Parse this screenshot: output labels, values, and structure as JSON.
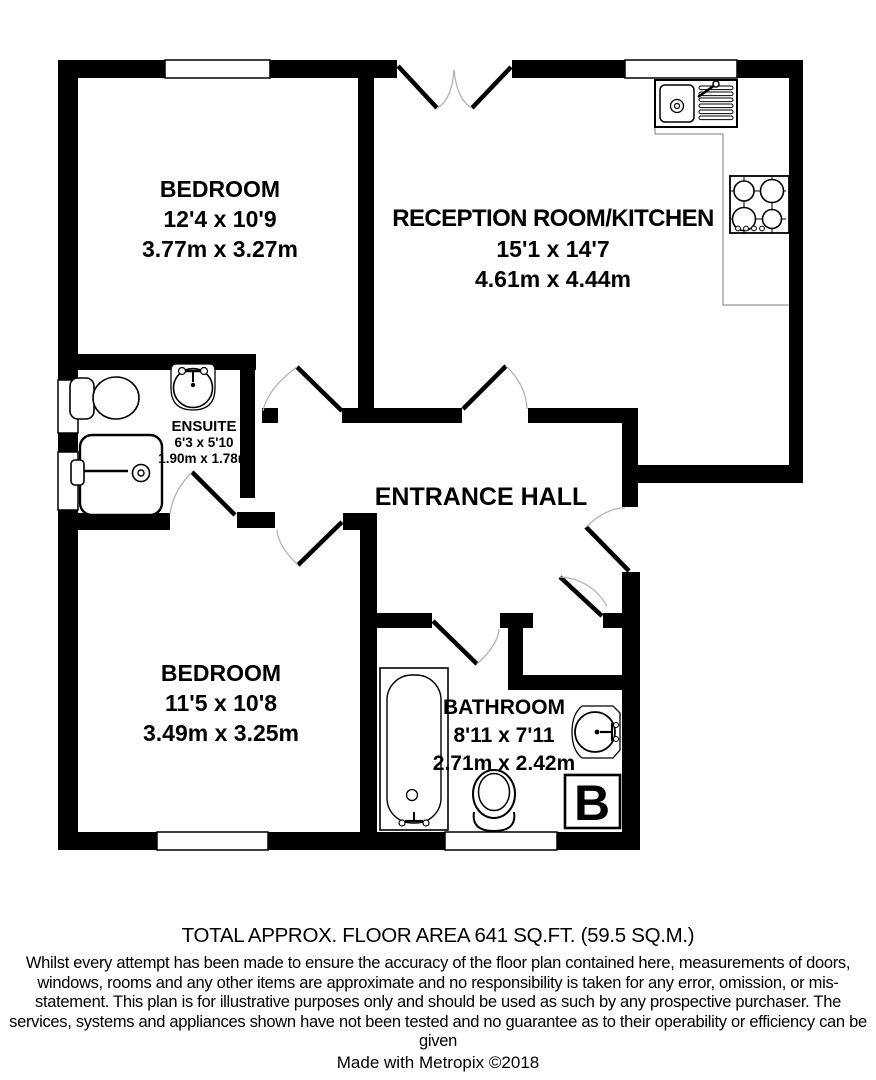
{
  "plan": {
    "rooms": [
      {
        "id": "bedroom-1",
        "name": "BEDROOM",
        "imperial": "12'4 x 10'9",
        "metric": "3.77m x 3.27m"
      },
      {
        "id": "reception-kitchen",
        "name": "RECEPTION ROOM/KITCHEN",
        "imperial": "15'1 x 14'7",
        "metric": "4.61m x 4.44m"
      },
      {
        "id": "ensuite",
        "name": "ENSUITE",
        "imperial": "6'3 x 5'10",
        "metric": "1.90m x 1.78m"
      },
      {
        "id": "entrance-hall",
        "name": "ENTRANCE HALL",
        "imperial": "",
        "metric": ""
      },
      {
        "id": "bedroom-2",
        "name": "BEDROOM",
        "imperial": "11'5 x 10'8",
        "metric": "3.49m x 3.25m"
      },
      {
        "id": "bathroom",
        "name": "BATHROOM",
        "imperial": "8'11 x 7'11",
        "metric": "2.71m x 2.42m"
      }
    ],
    "boiler_label": "B",
    "fixture_icons": [
      "kitchen-sink-drainer-icon",
      "gas-hob-icon",
      "ensuite-toilet-icon",
      "ensuite-basin-icon",
      "shower-icon",
      "bathtub-icon",
      "bathroom-toilet-icon",
      "bathroom-basin-icon",
      "boiler-icon"
    ],
    "colors": {
      "wall": "#000000",
      "door_arc": "#b3b3b3",
      "counter_outline": "#999999",
      "background": "#ffffff"
    }
  },
  "footer": {
    "total_area": "TOTAL APPROX. FLOOR AREA 641 SQ.FT. (59.5 SQ.M.)",
    "disclaimer": "Whilst every attempt has been made to ensure the accuracy of the floor plan contained here, measurements of doors, windows, rooms and any other items are approximate and no responsibility is taken for any error, omission, or mis-statement. This plan is for illustrative purposes only and should be used as such by any prospective purchaser. The services, systems and appliances shown have not been tested and no guarantee as to their operability or efficiency can be given",
    "credit": "Made with Metropix ©2018"
  }
}
